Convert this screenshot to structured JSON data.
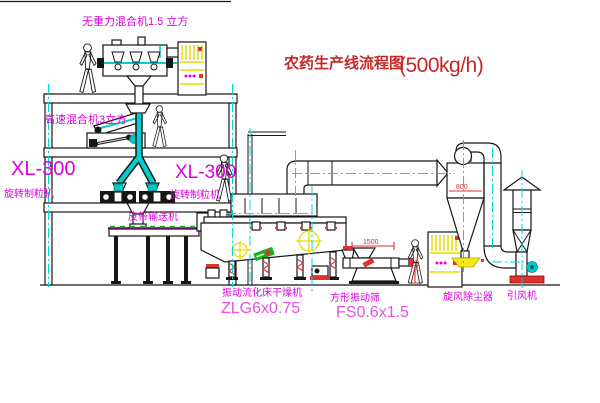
{
  "title": {
    "text": "农药生产线流程图",
    "capacity": "(500kg/h)"
  },
  "labels": {
    "gravity_free_mixer": "无重力混合机1.5 立方",
    "high_speed_mixer": "高速混合机3立方",
    "granulator_model_left": "XL-300",
    "granulator_name_left": "旋转制粒机",
    "granulator_model_right": "XL-300",
    "granulator_name_right": "旋转制粒机",
    "belt_conveyor": "皮带输送机",
    "dryer_name": "振动流化床干燥机",
    "dryer_model": "ZLG6x0.75",
    "sieve_name": "方形振动筛",
    "sieve_model": "FS0.6x1.5",
    "cyclone": "旋风除尘器",
    "fan": "引风机"
  },
  "dimensions": {
    "sieve_length": "1500",
    "sieve_height": "740",
    "cyclone_width": "800"
  },
  "colors": {
    "label_magenta": "#dd00dd",
    "model_pink": "#e64fe6",
    "title_red": "#c62828",
    "line_black": "#161616",
    "centerline_cyan": "#00d8d8",
    "cabinet_yellow": "#f2e81c",
    "accent_red": "#e03030",
    "accent_green": "#18b218"
  }
}
